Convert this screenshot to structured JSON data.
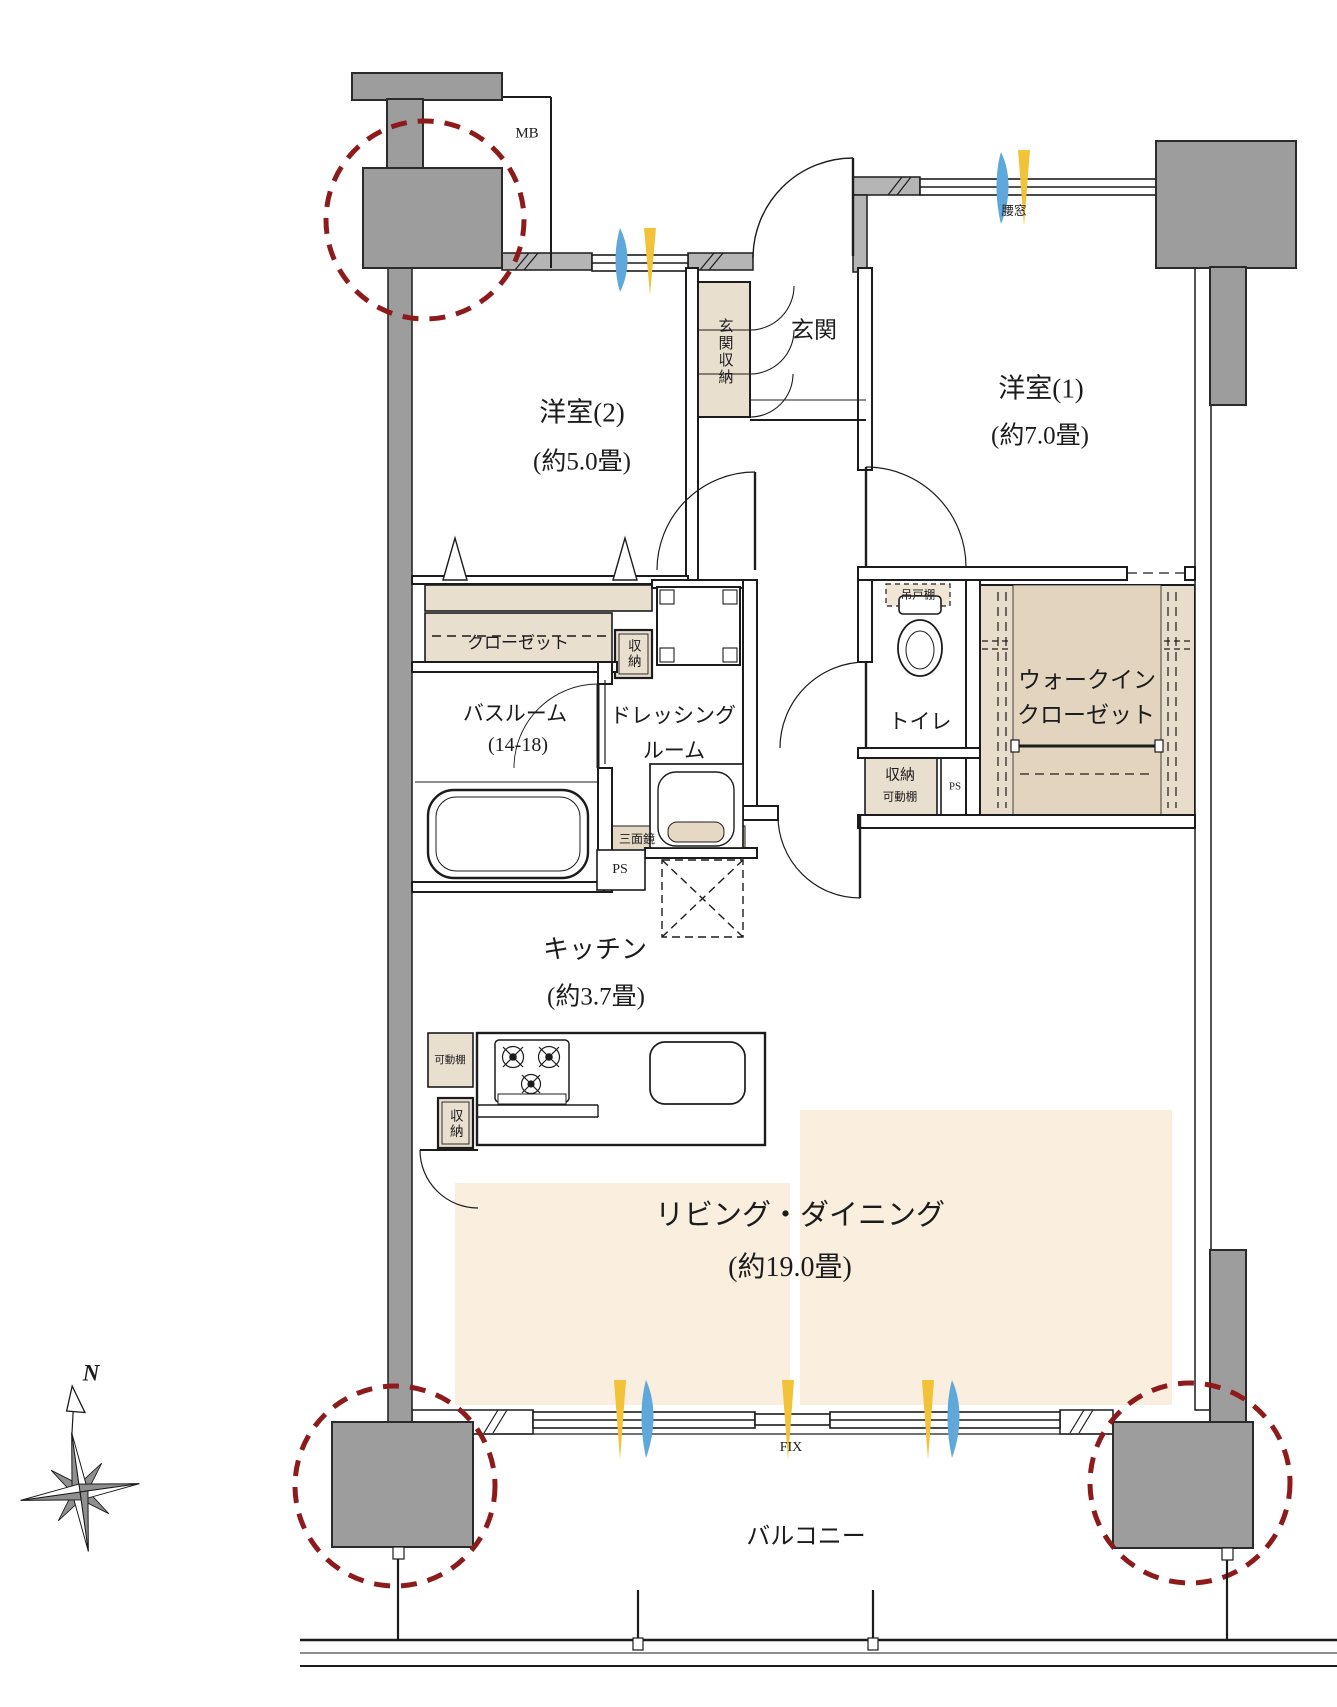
{
  "floor_plan": {
    "rooms": {
      "room2": {
        "name": "洋室(2)",
        "size": "(約5.0畳)"
      },
      "room1": {
        "name": "洋室(1)",
        "size": "(約7.0畳)"
      },
      "entrance": {
        "name": "玄関"
      },
      "bathroom": {
        "name": "バスルーム",
        "size": "(14-18)"
      },
      "dressing": {
        "line1": "ドレッシング",
        "line2": "ルーム"
      },
      "toilet": {
        "name": "トイレ"
      },
      "wic": {
        "line1": "ウォークイン",
        "line2": "クローゼット"
      },
      "kitchen": {
        "name": "キッチン",
        "size": "(約3.7畳)"
      },
      "living": {
        "name": "リビング・ダイニング",
        "size": "(約19.0畳)"
      },
      "balcony": {
        "name": "バルコニー"
      }
    },
    "storage": {
      "entrance_storage": "玄関収納",
      "closet": "クローゼット",
      "hall_storage": "収納",
      "hanging_cupboard": "吊戸棚",
      "shelf_storage_line1": "収納",
      "shelf_storage_line2": "可動棚",
      "movable_shelf": "可動棚",
      "kitchen_storage": "収納",
      "mirror": "三面鏡"
    },
    "annotations": {
      "mb": "MB",
      "ps_toilet": "PS",
      "ps_bath": "PS",
      "waist_window": "腰窓",
      "fix_window": "FIX",
      "compass_north": "N"
    },
    "colors": {
      "pillar_gray": "#9d9d9d",
      "wall_band_gray": "#b5b5b5",
      "storage_beige": "#e9dfce",
      "wic_beige": "#e2d4bf",
      "floor_cream": "#faeede",
      "circle_red": "#8e1b1b",
      "vent_yellow": "#f2c238",
      "vent_blue": "#5fa8dc",
      "line_black": "#1c1c1c"
    }
  }
}
